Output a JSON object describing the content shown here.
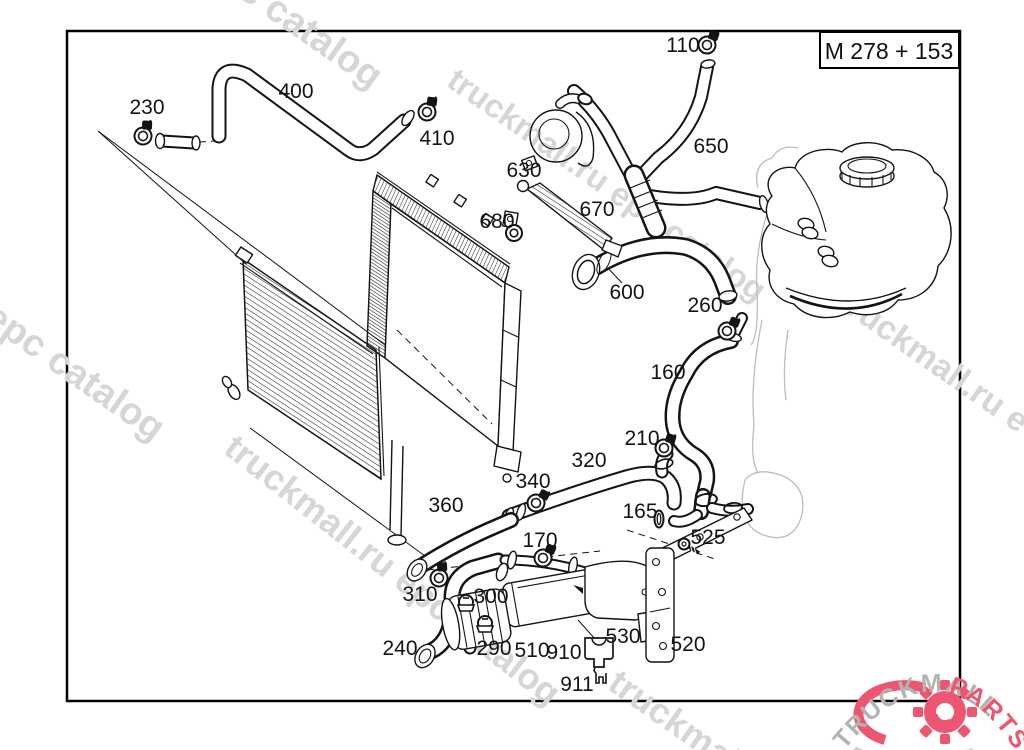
{
  "frame": {
    "title": "M 278 + 153"
  },
  "colors": {
    "line": "#141414",
    "watermark": "#d6d6d6",
    "logo_gray": "#b3b3b3",
    "logo_pink": "#ee5570"
  },
  "watermarks": [
    {
      "text": "epc catalog",
      "x": 200,
      "y": -30,
      "size": 38,
      "rot": 35
    },
    {
      "text": "truckmall.ru epc catalog",
      "x": 445,
      "y": 85,
      "size": 33,
      "rot": 35
    },
    {
      "text": "l epc catalog",
      "x": -35,
      "y": 310,
      "size": 38,
      "rot": 35
    },
    {
      "text": "truckmall.ru epc catalog",
      "x": 222,
      "y": 452,
      "size": 36,
      "rot": 38
    },
    {
      "text": "truckmall.ru e",
      "x": 836,
      "y": 306,
      "size": 34,
      "rot": 35
    },
    {
      "text": "truckmall",
      "x": 606,
      "y": 688,
      "size": 36,
      "rot": 35
    }
  ],
  "diagram": {
    "labels": [
      {
        "id": "110",
        "x": 683,
        "y": 45,
        "icon": {
          "type": "clamp",
          "x": 707,
          "y": 45,
          "rot": 0
        }
      },
      {
        "id": "230",
        "x": 147,
        "y": 107,
        "icon": {
          "type": "clamp",
          "x": 143,
          "y": 136,
          "rot": -15
        }
      },
      {
        "id": "400",
        "x": 296,
        "y": 91
      },
      {
        "id": "410",
        "x": 437,
        "y": 138,
        "icon": {
          "type": "clamp",
          "x": 427,
          "y": 112,
          "rot": -10
        }
      },
      {
        "id": "630",
        "x": 524,
        "y": 170
      },
      {
        "id": "650",
        "x": 711,
        "y": 146
      },
      {
        "id": "670",
        "x": 597,
        "y": 209
      },
      {
        "id": "680",
        "x": 497,
        "y": 221,
        "icon": {
          "type": "grommet",
          "x": 514,
          "y": 233,
          "rot": 0
        }
      },
      {
        "id": "600",
        "x": 627,
        "y": 292
      },
      {
        "id": "260",
        "x": 705,
        "y": 305,
        "icon": {
          "type": "clamp",
          "x": 727,
          "y": 331,
          "rot": 5
        }
      },
      {
        "id": "160",
        "x": 668,
        "y": 372
      },
      {
        "id": "210",
        "x": 642,
        "y": 438,
        "icon": {
          "type": "clamp",
          "x": 664,
          "y": 448,
          "rot": 0
        }
      },
      {
        "id": "320",
        "x": 589,
        "y": 460
      },
      {
        "id": "340",
        "x": 533,
        "y": 481,
        "icon": {
          "type": "clamp",
          "x": 536,
          "y": 503,
          "rot": 10
        }
      },
      {
        "id": "360",
        "x": 446,
        "y": 505
      },
      {
        "id": "165",
        "x": 640,
        "y": 511,
        "icon": {
          "type": "ring",
          "x": 659,
          "y": 519,
          "rot": 0
        }
      },
      {
        "id": "525",
        "x": 708,
        "y": 537,
        "icon": {
          "type": "screw",
          "x": 684,
          "y": 544,
          "rot": 0
        }
      },
      {
        "id": "170",
        "x": 540,
        "y": 540,
        "icon": {
          "type": "clamp",
          "x": 543,
          "y": 558,
          "rot": 5
        }
      },
      {
        "id": "310",
        "x": 420,
        "y": 594,
        "icon": {
          "type": "clamp",
          "x": 439,
          "y": 578,
          "rot": -20
        }
      },
      {
        "id": "300",
        "x": 491,
        "y": 596,
        "icon": {
          "type": "clip",
          "x": 466,
          "y": 602,
          "rot": 0
        }
      },
      {
        "id": "240",
        "x": 400,
        "y": 648
      },
      {
        "id": "290",
        "x": 494,
        "y": 648,
        "icon": {
          "type": "clip",
          "x": 485,
          "y": 623,
          "rot": 0
        }
      },
      {
        "id": "510",
        "x": 532,
        "y": 650
      },
      {
        "id": "910",
        "x": 564,
        "y": 652,
        "icon": {
          "type": "box",
          "x": 599,
          "y": 651,
          "rot": 0
        }
      },
      {
        "id": "911",
        "x": 577,
        "y": 684,
        "icon": {
          "type": "fork",
          "x": 601,
          "y": 681,
          "rot": 0
        }
      },
      {
        "id": "530",
        "x": 623,
        "y": 636
      },
      {
        "id": "520",
        "x": 688,
        "y": 644
      }
    ]
  },
  "logo": {
    "text_gray": "TRUCKMALL",
    "text_pink": "PARTS"
  }
}
